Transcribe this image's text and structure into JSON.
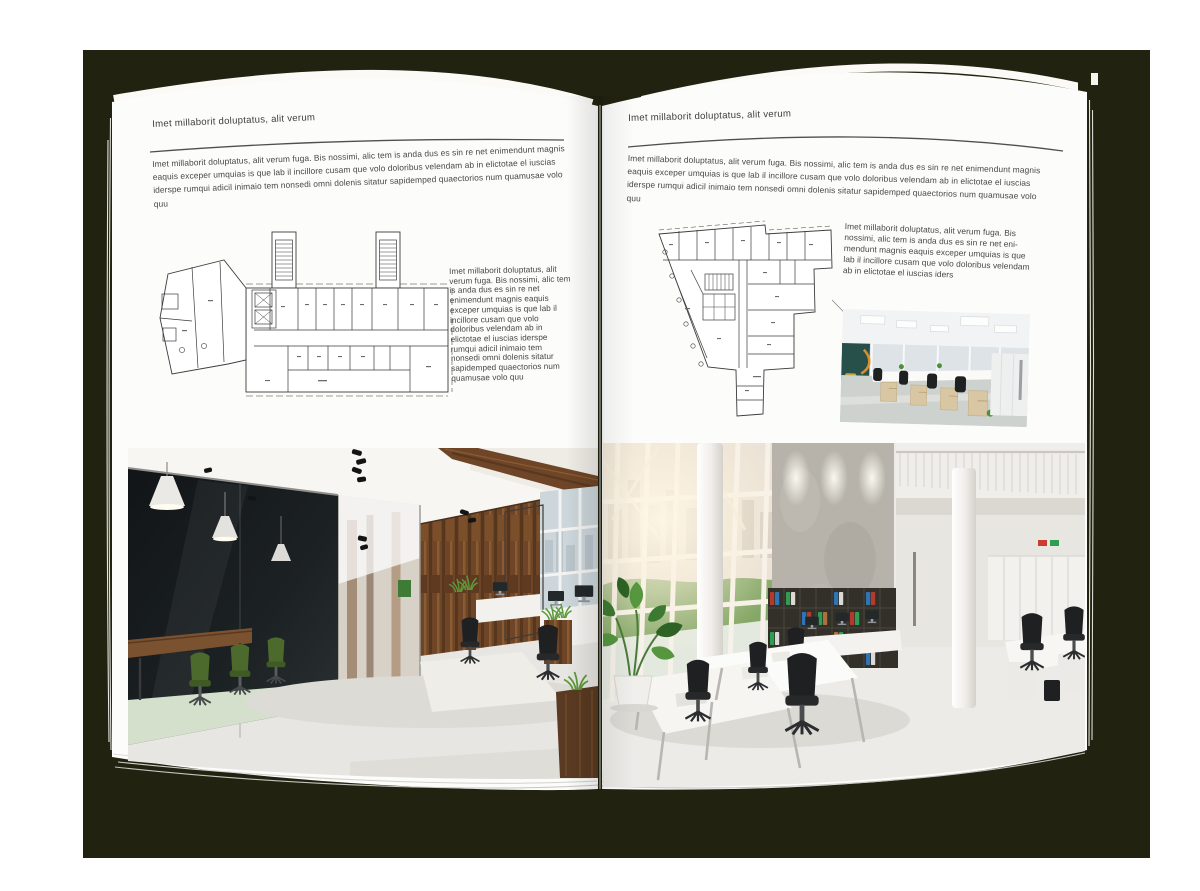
{
  "colors": {
    "backdrop": "#21220f",
    "page": "#fcfcfa",
    "heading_text": "#3d3d3d",
    "body_text": "#474747",
    "rule": "#4f4f4f"
  },
  "left_page": {
    "header": "Imet millaborit doluptatus, alit verum",
    "intro": "Imet millaborit doluptatus, alit verum fuga. Bis nossimi, alic tem is anda dus es sin re net enimendunt magnis eaquis exceper umquias is que lab il incillore cusam que volo doloribus velendam ab in elictotae el iuscias iderspe rumqui adicil inimaio tem nonsedi omni dolenis sitatur sapidemped quaectorios num quamusae volo quu",
    "side_text": "Imet millaborit doluptatus, alit verum fuga. Bis nossimi, alic tem is anda dus es sin re net enimendunt magnis eaquis exceper umquias is que lab il incillore cusam que volo doloribus velendam ab in elictotae el iuscias iderspe rumqui adicil inimaio tem nonsedi omni dolenis sitatur sapidemped quaectorios num quamusae volo quu"
  },
  "right_page": {
    "header": "Imet millaborit doluptatus, alit verum",
    "intro": "Imet millaborit doluptatus, alit verum fuga. Bis nossimi, alic tem is anda dus es sin re net enimendunt magnis eaquis exceper umquias is que lab il incillore cusam que volo doloribus velendam ab in elictotae el iuscias iderspe rumqui adicil inimaio tem nonsedi omni dolenis sitatur sapidemped quaectorios num quamusae volo quu",
    "side_text": "Imet millaborit doluptatus, alit verum fuga. Bis nossimi, alic tem is anda dus es sin re net eni-mendunt magnis eaquis exceper umquias is que lab il incillore cusam que volo doloribus velendam ab in elictotae el iuscias iders"
  },
  "figures": {
    "left_floor_plan": "architectural floor plan of elongated office building with two stair towers",
    "right_floor_plan": "architectural floor plan of wedge-shaped office building",
    "left_photo": "loft office with dark glass meeting room, green chairs and wooden wall",
    "right_photo": "bright double-height office with white desks, concrete wall and binder shelf",
    "small_photo": "open-plan office with rows of desks and black chairs"
  }
}
